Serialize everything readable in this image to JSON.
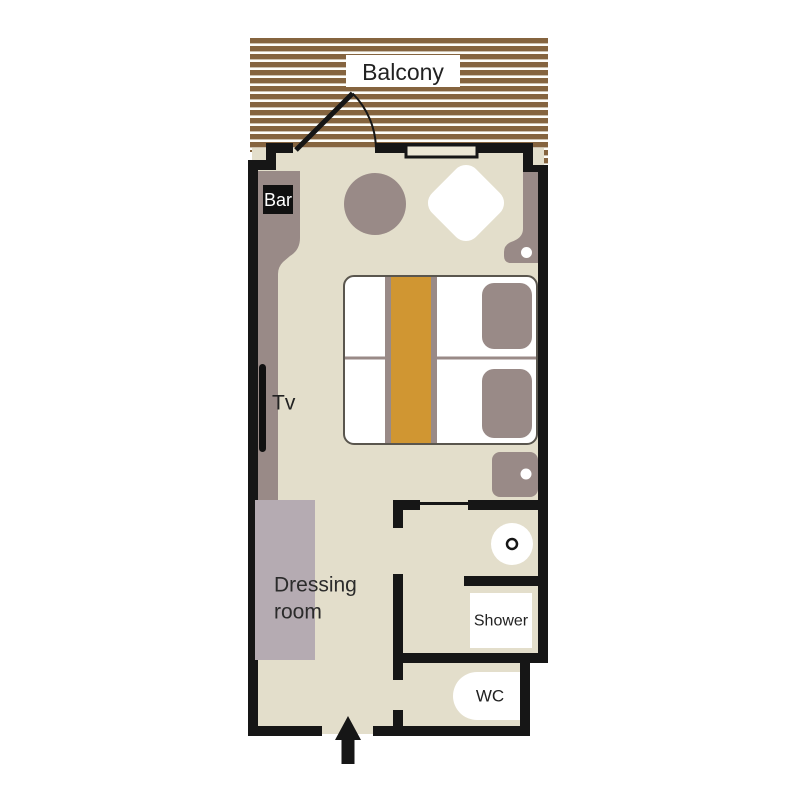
{
  "floorplan": {
    "labels": {
      "balcony": "Balcony",
      "bar": "Bar",
      "tv": "Tv",
      "dressing_lines": [
        "Dressing",
        "room"
      ],
      "shower": "Shower",
      "wc": "WC"
    },
    "colors": {
      "deck_brown": "#85643f",
      "deck_gap": "#fdfdf9",
      "floor_beige": "#e3decb",
      "wall_black": "#161616",
      "furniture_taupe": "#998a87",
      "bed_runner_orange": "#d09632",
      "dressing_gray": "#b5abb2",
      "bed_outline": "#5a564e",
      "fixture_white": "#ffffff"
    }
  }
}
